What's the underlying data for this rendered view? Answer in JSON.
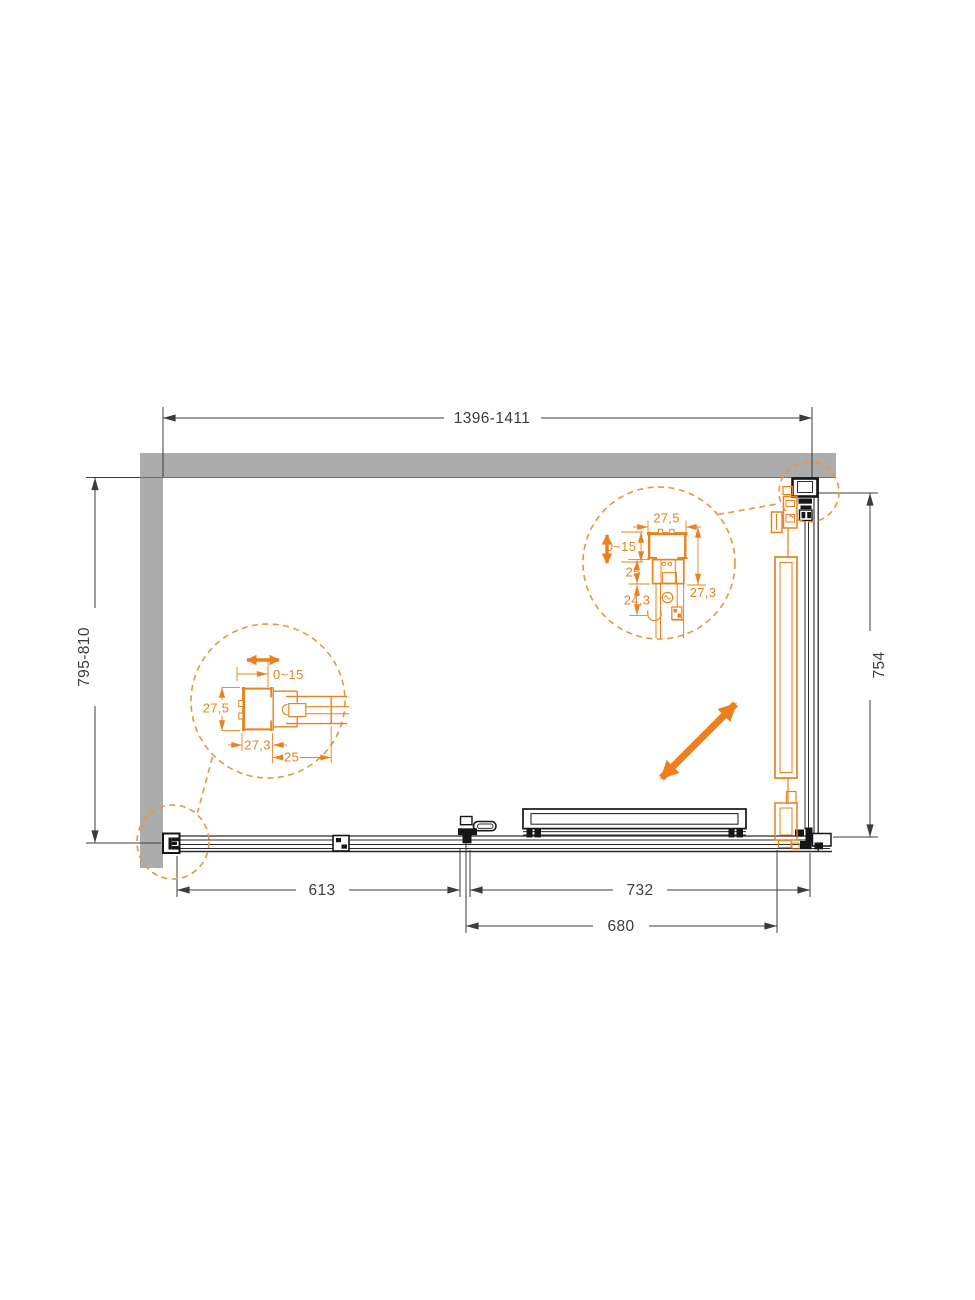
{
  "drawing": {
    "type": "shower-enclosure-plan-view",
    "colors": {
      "wall": "#acacac",
      "structure": "#2b2b2b",
      "dimension_text": "#3c3c3c",
      "accent_orange": "#ee7f1d"
    },
    "dimensions": {
      "total_width": "1396-1411",
      "total_depth": "795-810",
      "side_panel_width": "754",
      "fixed_segment_width": "613",
      "door_segment_width": "732",
      "door_glass_width": "680"
    },
    "detail_left": {
      "adjustment_range": "0~15",
      "profile_depth": "27,5",
      "profile_width": "27,3",
      "insert_width": "25"
    },
    "detail_right": {
      "profile_width": "27,5",
      "adjustment_range": "0~15",
      "insert_depth": "25",
      "carriage_depth": "24,3",
      "profile_depth": "27,3"
    }
  }
}
